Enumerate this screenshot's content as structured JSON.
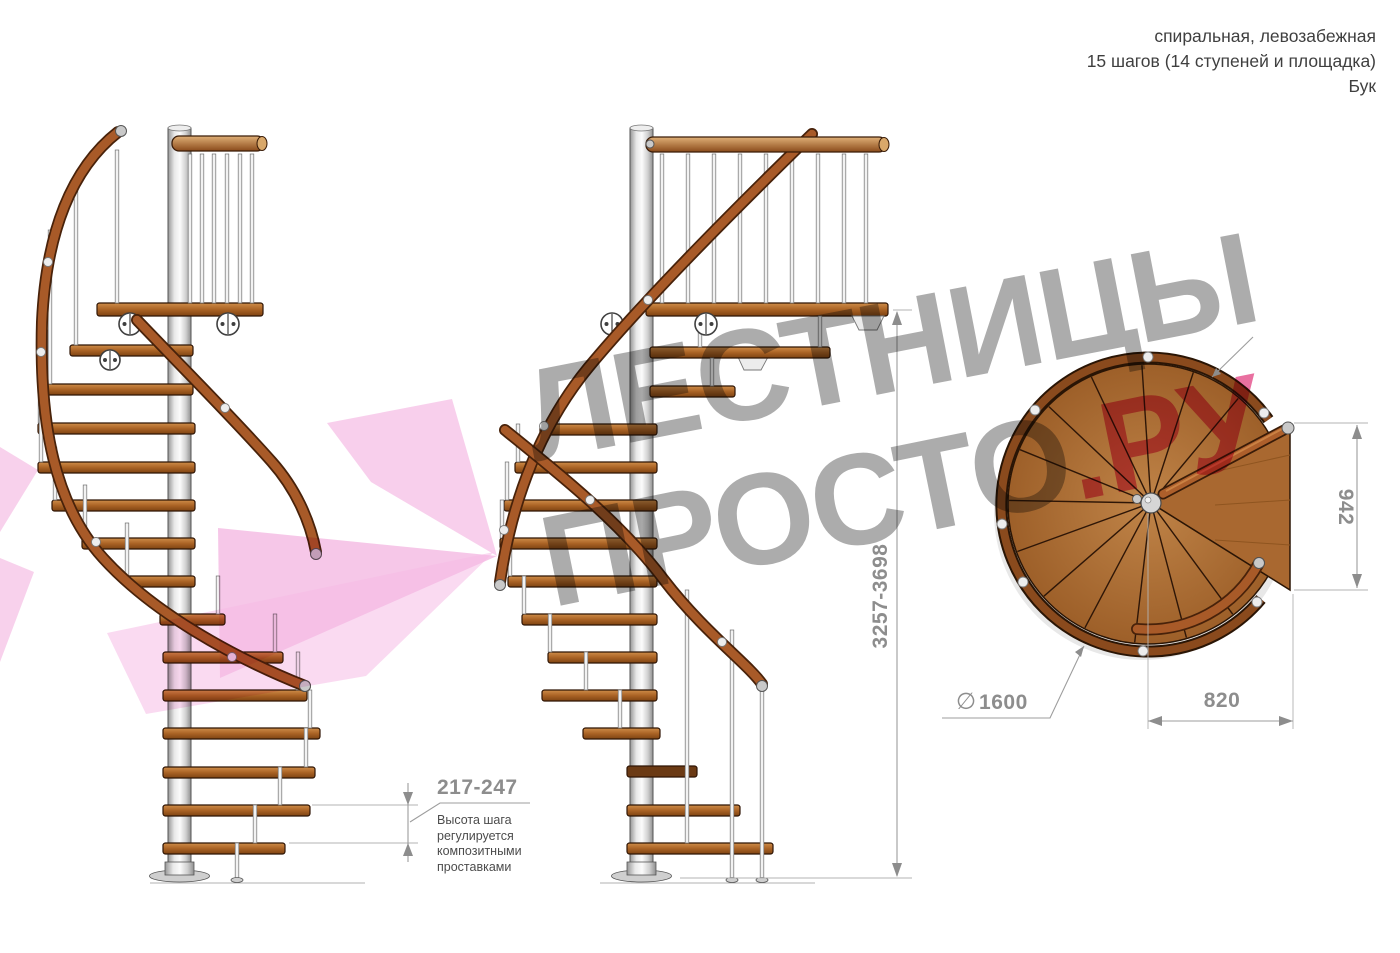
{
  "header": {
    "type_line": "спиральная, левозабежная",
    "steps_line": "15 шагов (14 ступеней и площадка)",
    "material_line": "Бук"
  },
  "dimensions": {
    "step_height": "217-247",
    "total_height": "3257-3698",
    "landing_side": "942",
    "landing_width": "820",
    "diameter_symbol": "∅",
    "diameter_value": "1600"
  },
  "note": {
    "line1": "Высота шага",
    "line2": "регулируется",
    "line3": "композитными",
    "line4": "проставками"
  },
  "watermark": {
    "line1": "ЛЕСТНИЦЫ",
    "line2_gray": "ПРОСТО",
    "line2_pink": ".РУ"
  },
  "colors": {
    "wood_step": "#aa6325",
    "wood_disc": "#a96830",
    "handrail": "#a85a28",
    "metal_pole": "#d9d9d9",
    "dimension_gray": "#8d8d8d",
    "text_dark": "#3f3f3f",
    "watermark_gray": "#909090",
    "watermark_pink": "#e23f80",
    "logo_pink": "#f2a7da"
  }
}
